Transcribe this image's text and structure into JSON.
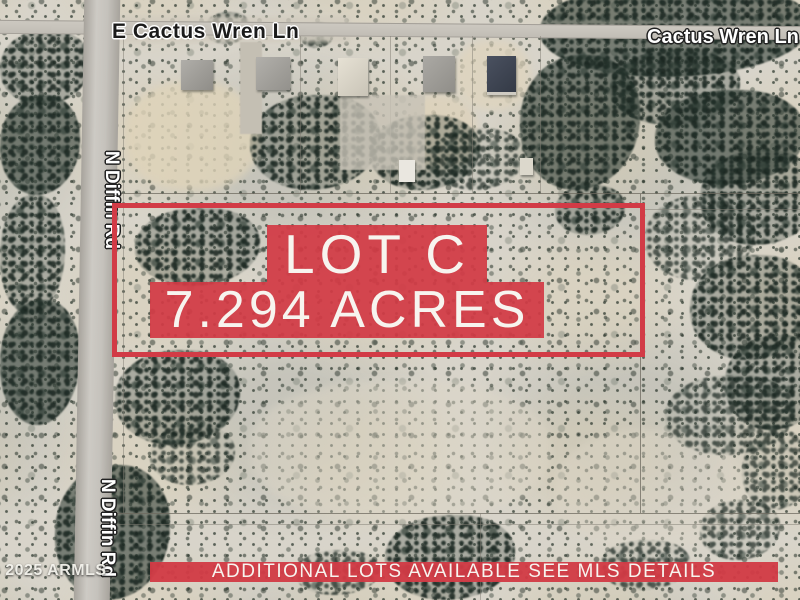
{
  "colors": {
    "overlay-red": "#d23b46",
    "overlay-text": "#f7f4ef",
    "label-dark": "#1b1b1b",
    "label-light": "#ffffff",
    "desert-base": "#d8d4ca"
  },
  "road_labels": {
    "top_left": "E Cactus Wren Ln",
    "top_right": "Cactus Wren Ln",
    "left_upper": "N Diffin Rd",
    "left_lower": "N Diffin Rd"
  },
  "overlay": {
    "lot_title": "LOT C",
    "lot_acreage": "7.294 ACRES",
    "banner": "ADDITIONAL LOTS AVAILABLE SEE MLS DETAILS"
  },
  "watermark": "© 2025 ARMLS"
}
